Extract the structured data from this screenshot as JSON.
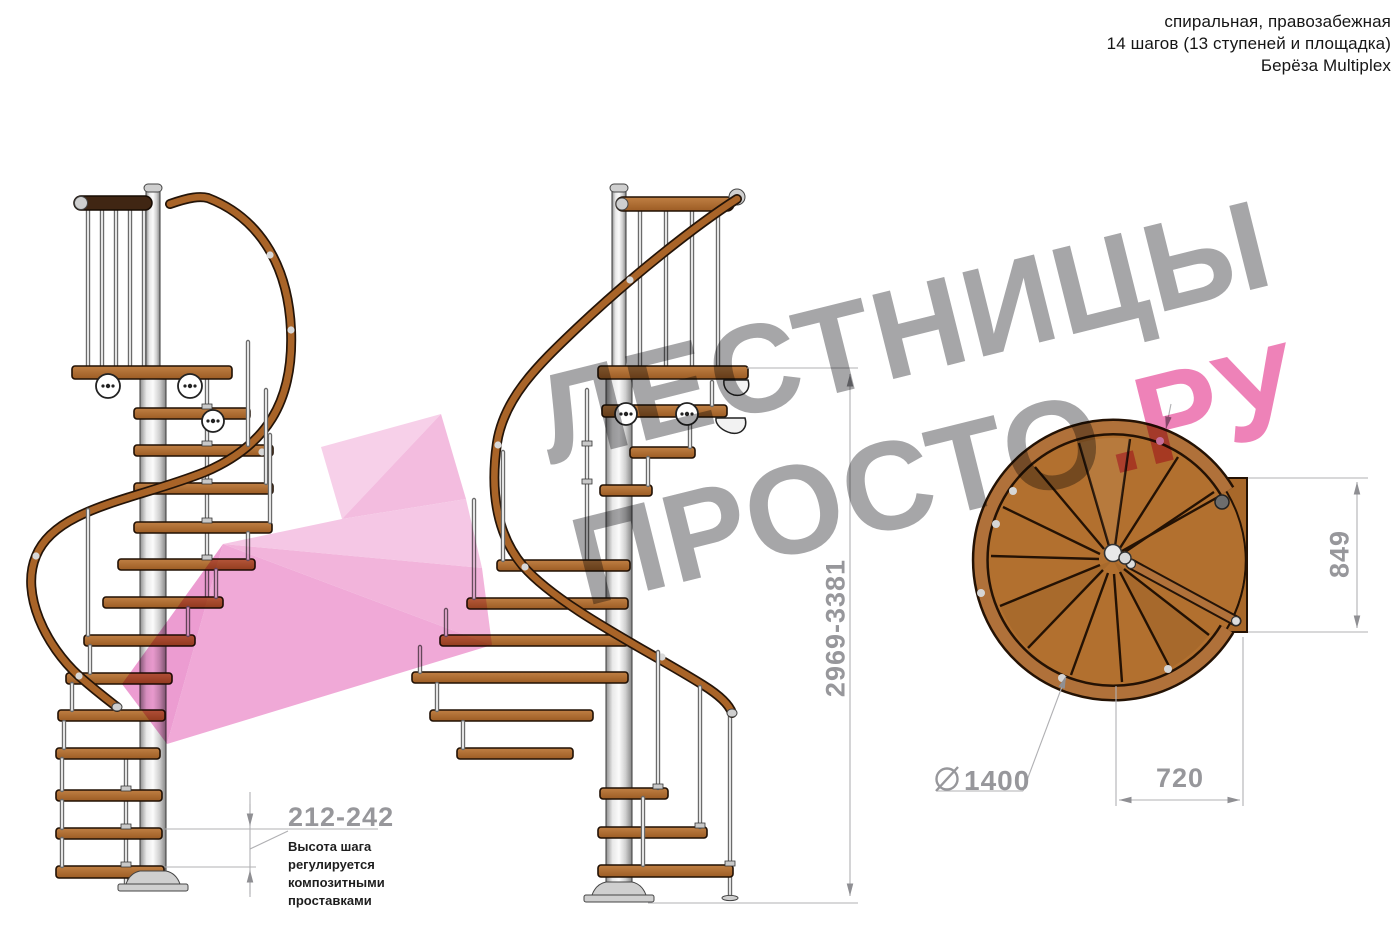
{
  "header": {
    "line1": "спиральная, правозабежная",
    "line2": "14 шагов (13 ступеней и площадка)",
    "line3": "Берёза Multiplex"
  },
  "watermark": {
    "line1": "ЛЕСТНИЦЫ",
    "line2_gray": "ПРОСТО",
    "line2_accent": ".РУ",
    "gray_color": "#a6a6a8",
    "accent_color": "#ee82b8"
  },
  "dimensions": {
    "step_height": {
      "value": "212-242",
      "note_lines": [
        "Высота шага",
        "регулируется",
        "композитными",
        "проставками"
      ]
    },
    "total_height": {
      "value": "2969-3381"
    },
    "landing_depth": {
      "value": "849"
    },
    "tread_width": {
      "value": "720"
    },
    "diameter": {
      "value": "1400"
    }
  },
  "drawing": {
    "views": [
      "side-elevation-left",
      "side-elevation-rotated",
      "plan-view"
    ],
    "colors": {
      "wood": "#ab6a2e",
      "wood_dark": "#402613",
      "handrail": "#a96428",
      "pole_metal": "#d9d9d9",
      "dimension_gray": "#97979b",
      "arrow_pink_light": "#f7d0e9",
      "arrow_pink_dark": "#ec9cd1"
    }
  }
}
